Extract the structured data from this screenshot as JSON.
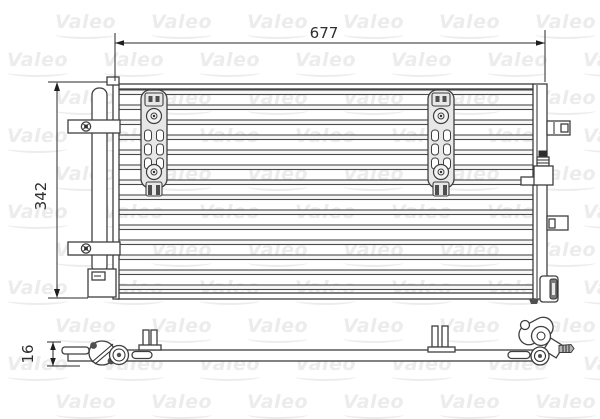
{
  "watermark": {
    "text": "Valeo"
  },
  "dimensions": {
    "width_label": "677",
    "height_label": "342",
    "depth_label": "16"
  },
  "front_view": {
    "tube_count": 14,
    "bracket_count": 2
  },
  "colors": {
    "line": "#3f3f3f",
    "dimension": "#2a2a2a",
    "part_fill": "#e7e7e7",
    "watermark": "#ececec",
    "background": "#ffffff"
  }
}
